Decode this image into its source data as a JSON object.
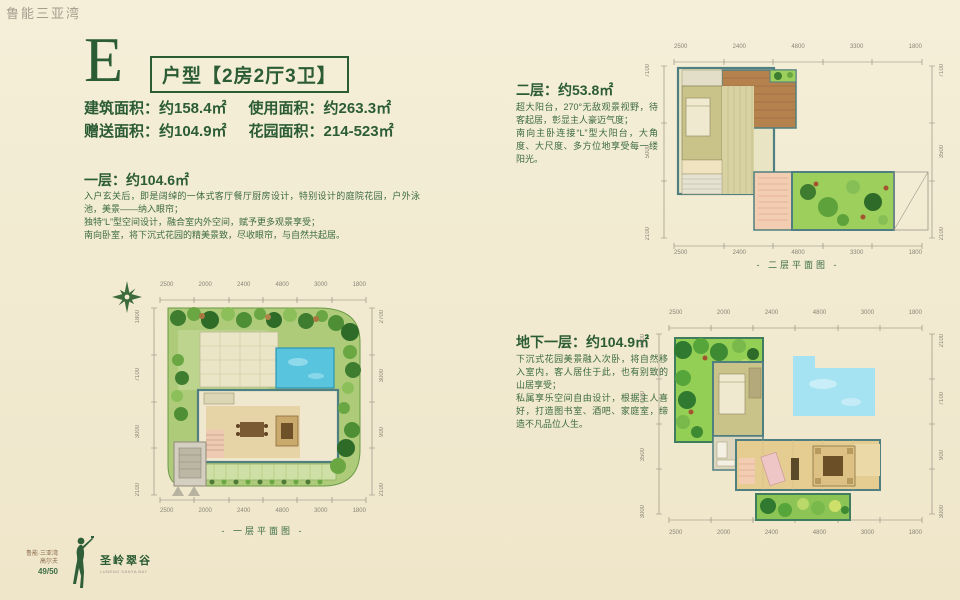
{
  "watermark": "鲁能三亚湾",
  "title": {
    "letter": "E",
    "boxed": "户型【2房2厅3卫】"
  },
  "areas": {
    "building": "建筑面积：约158.4㎡",
    "usable": "使用面积：约263.3㎡",
    "gift": "赠送面积：约104.9㎡",
    "garden": "花园面积：214-523㎡"
  },
  "floor1": {
    "heading": "一层：约104.6㎡",
    "body": "入户玄关后，即是阔绰的一体式客厅餐厅厨房设计，特别设计的庭院花园，户外泳池，美景——纳入眼帘；\n独特“L”型空间设计，融合室内外空间，赋予更多观景享受；\n南向卧室，将下沉式花园的精美景致，尽收眼帘，与自然共起居。",
    "caption": "- 一层平面图 -"
  },
  "floor2": {
    "heading": "二层：约53.8㎡",
    "body": "超大阳台，270°无敌观景视野，待客起居，彰显主人豪迈气度；\n南向主卧连接“L”型大阳台，大角度、大尺度、多方位地享受每一缕阳光。",
    "caption": "- 二层平面图 -"
  },
  "basement": {
    "heading": "地下一层：约104.9㎡",
    "body": "下沉式花园美景融入次卧，将自然移入室内，客人居住于此，也有别致的山居享受；\n私属享乐空间自由设计，根据主人喜好，打造图书室、酒吧、家庭室，缔造不凡品位人生。"
  },
  "logo": {
    "brand_line1": "鲁能·三亚湾",
    "brand_line2": "高尔夫",
    "page_no": "49/50",
    "name": "圣岭翠谷",
    "name_sub": "LUNENG SANYA BAY"
  },
  "dims": {
    "plan1": {
      "top": [
        "2500",
        "2000",
        "2400",
        "4800",
        "3000",
        "1800"
      ],
      "bottom": [
        "2500",
        "2000",
        "2400",
        "4800",
        "3000",
        "1800"
      ],
      "left": [
        "1800",
        "7100",
        "3000",
        "2100"
      ],
      "right": [
        "2700",
        "3000",
        "900",
        "2100"
      ]
    },
    "plan2": {
      "top": [
        "2500",
        "2400",
        "4800",
        "3300",
        "1800"
      ],
      "bottom": [
        "2500",
        "2400",
        "4800",
        "3300",
        "1800"
      ],
      "left": [
        "7100",
        "5000",
        "2100"
      ],
      "right": [
        "7100",
        "3500",
        "2100"
      ]
    },
    "plan3": {
      "top": [
        "2500",
        "2000",
        "2400",
        "4800",
        "3000",
        "1800"
      ],
      "bottom": [
        "2500",
        "2000",
        "2400",
        "4800",
        "3000",
        "1800"
      ],
      "left": [
        "2100",
        "7100",
        "3500",
        "3000"
      ],
      "right": [
        "2100",
        "7100",
        "900",
        "3000"
      ]
    }
  },
  "colors": {
    "accent_green": "#2b5c33",
    "pool_blue": "#58c4dd",
    "garden_green": "#8cc455",
    "background": "#f2ebd2"
  }
}
